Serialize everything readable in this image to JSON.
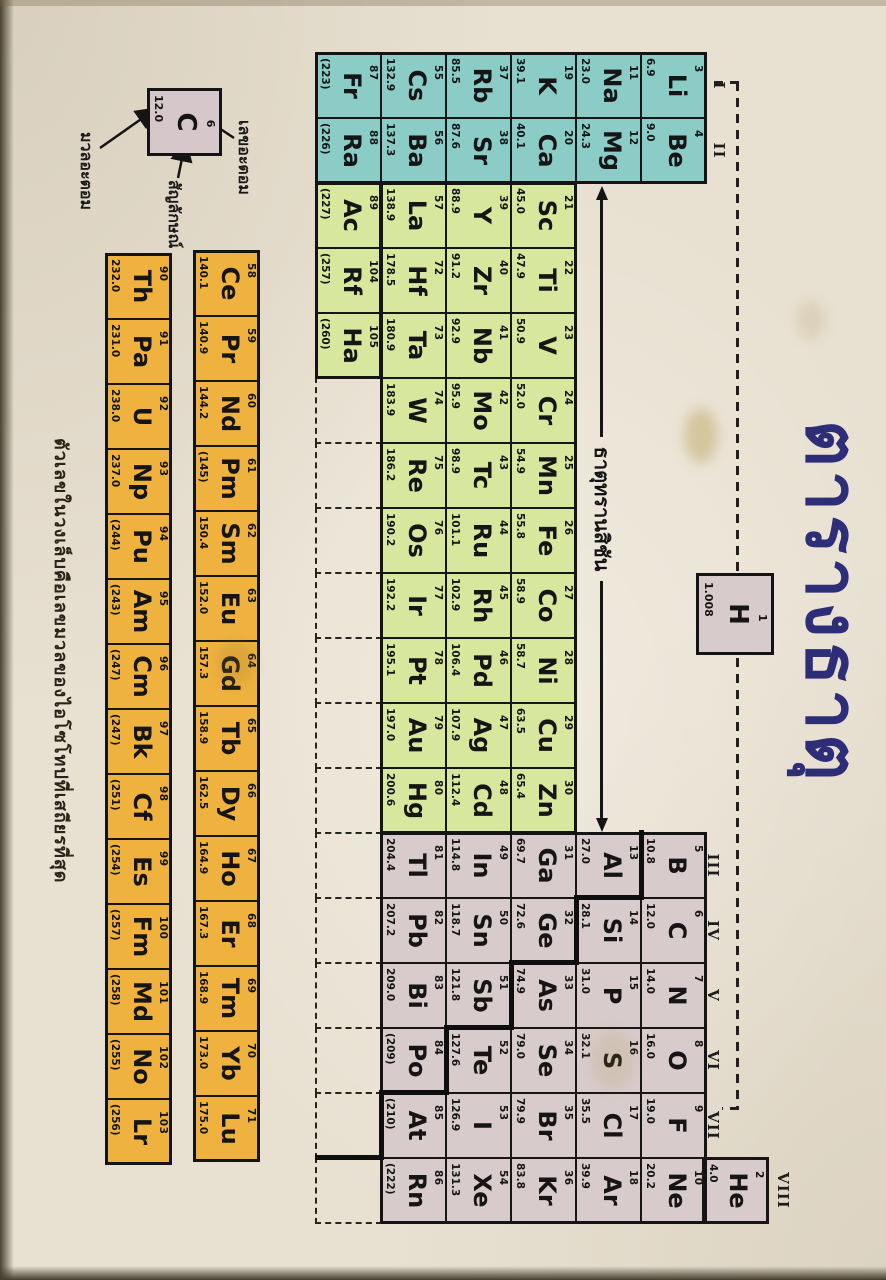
{
  "title": "ตารางธาตุ",
  "transition_label": "ธาตุทรานสิชัน",
  "footnote": "ตัวเลขในวงเล็บคือเลขมวลของไอโซโทปที่เสถียรที่สุด",
  "legend": {
    "number": "6",
    "symbol": "C",
    "mass": "12.0",
    "number_label": "เลขอะตอม",
    "symbol_label": "สัญลักษณ์",
    "mass_label": "มวลอะตอม"
  },
  "group_labels": [
    {
      "label": "I",
      "col": 1
    },
    {
      "label": "II",
      "col": 2
    },
    {
      "label": "III",
      "col": 13
    },
    {
      "label": "IV",
      "col": 14
    },
    {
      "label": "V",
      "col": 15
    },
    {
      "label": "VI",
      "col": 16
    },
    {
      "label": "VII",
      "col": 17
    },
    {
      "label": "VIII",
      "col": 18
    }
  ],
  "hydrogen": {
    "symbol": "H",
    "number": "1",
    "mass": "1.008"
  },
  "helium": {
    "symbol": "He",
    "number": "2",
    "mass": "4.0"
  },
  "elements": [
    {
      "symbol": "Li",
      "number": "3",
      "mass": "6.9",
      "col": 1,
      "row": 2
    },
    {
      "symbol": "Be",
      "number": "4",
      "mass": "9.0",
      "col": 2,
      "row": 2
    },
    {
      "symbol": "B",
      "number": "5",
      "mass": "10.8",
      "col": 13,
      "row": 2
    },
    {
      "symbol": "C",
      "number": "6",
      "mass": "12.0",
      "col": 14,
      "row": 2
    },
    {
      "symbol": "N",
      "number": "7",
      "mass": "14.0",
      "col": 15,
      "row": 2
    },
    {
      "symbol": "O",
      "number": "8",
      "mass": "16.0",
      "col": 16,
      "row": 2
    },
    {
      "symbol": "F",
      "number": "9",
      "mass": "19.0",
      "col": 17,
      "row": 2
    },
    {
      "symbol": "Ne",
      "number": "10",
      "mass": "20.2",
      "col": 18,
      "row": 2
    },
    {
      "symbol": "Na",
      "number": "11",
      "mass": "23.0",
      "col": 1,
      "row": 3
    },
    {
      "symbol": "Mg",
      "number": "12",
      "mass": "24.3",
      "col": 2,
      "row": 3
    },
    {
      "symbol": "Al",
      "number": "13",
      "mass": "27.0",
      "col": 13,
      "row": 3
    },
    {
      "symbol": "Si",
      "number": "14",
      "mass": "28.1",
      "col": 14,
      "row": 3
    },
    {
      "symbol": "P",
      "number": "15",
      "mass": "31.0",
      "col": 15,
      "row": 3
    },
    {
      "symbol": "S",
      "number": "16",
      "mass": "32.1",
      "col": 16,
      "row": 3
    },
    {
      "symbol": "Cl",
      "number": "17",
      "mass": "35.5",
      "col": 17,
      "row": 3
    },
    {
      "symbol": "Ar",
      "number": "18",
      "mass": "39.9",
      "col": 18,
      "row": 3
    },
    {
      "symbol": "K",
      "number": "19",
      "mass": "39.1",
      "col": 1,
      "row": 4
    },
    {
      "symbol": "Ca",
      "number": "20",
      "mass": "40.1",
      "col": 2,
      "row": 4
    },
    {
      "symbol": "Sc",
      "number": "21",
      "mass": "45.0",
      "col": 3,
      "row": 4
    },
    {
      "symbol": "Ti",
      "number": "22",
      "mass": "47.9",
      "col": 4,
      "row": 4
    },
    {
      "symbol": "V",
      "number": "23",
      "mass": "50.9",
      "col": 5,
      "row": 4
    },
    {
      "symbol": "Cr",
      "number": "24",
      "mass": "52.0",
      "col": 6,
      "row": 4
    },
    {
      "symbol": "Mn",
      "number": "25",
      "mass": "54.9",
      "col": 7,
      "row": 4
    },
    {
      "symbol": "Fe",
      "number": "26",
      "mass": "55.8",
      "col": 8,
      "row": 4
    },
    {
      "symbol": "Co",
      "number": "27",
      "mass": "58.9",
      "col": 9,
      "row": 4
    },
    {
      "symbol": "Ni",
      "number": "28",
      "mass": "58.7",
      "col": 10,
      "row": 4
    },
    {
      "symbol": "Cu",
      "number": "29",
      "mass": "63.5",
      "col": 11,
      "row": 4
    },
    {
      "symbol": "Zn",
      "number": "30",
      "mass": "65.4",
      "col": 12,
      "row": 4
    },
    {
      "symbol": "Ga",
      "number": "31",
      "mass": "69.7",
      "col": 13,
      "row": 4
    },
    {
      "symbol": "Ge",
      "number": "32",
      "mass": "72.6",
      "col": 14,
      "row": 4
    },
    {
      "symbol": "As",
      "number": "33",
      "mass": "74.9",
      "col": 15,
      "row": 4
    },
    {
      "symbol": "Se",
      "number": "34",
      "mass": "79.0",
      "col": 16,
      "row": 4
    },
    {
      "symbol": "Br",
      "number": "35",
      "mass": "79.9",
      "col": 17,
      "row": 4
    },
    {
      "symbol": "Kr",
      "number": "36",
      "mass": "83.8",
      "col": 18,
      "row": 4
    },
    {
      "symbol": "Rb",
      "number": "37",
      "mass": "85.5",
      "col": 1,
      "row": 5
    },
    {
      "symbol": "Sr",
      "number": "38",
      "mass": "87.6",
      "col": 2,
      "row": 5
    },
    {
      "symbol": "Y",
      "number": "39",
      "mass": "88.9",
      "col": 3,
      "row": 5
    },
    {
      "symbol": "Zr",
      "number": "40",
      "mass": "91.2",
      "col": 4,
      "row": 5
    },
    {
      "symbol": "Nb",
      "number": "41",
      "mass": "92.9",
      "col": 5,
      "row": 5
    },
    {
      "symbol": "Mo",
      "number": "42",
      "mass": "95.9",
      "col": 6,
      "row": 5
    },
    {
      "symbol": "Tc",
      "number": "43",
      "mass": "98.9",
      "col": 7,
      "row": 5
    },
    {
      "symbol": "Ru",
      "number": "44",
      "mass": "101.1",
      "col": 8,
      "row": 5
    },
    {
      "symbol": "Rh",
      "number": "45",
      "mass": "102.9",
      "col": 9,
      "row": 5
    },
    {
      "symbol": "Pd",
      "number": "46",
      "mass": "106.4",
      "col": 10,
      "row": 5
    },
    {
      "symbol": "Ag",
      "number": "47",
      "mass": "107.9",
      "col": 11,
      "row": 5
    },
    {
      "symbol": "Cd",
      "number": "48",
      "mass": "112.4",
      "col": 12,
      "row": 5
    },
    {
      "symbol": "In",
      "number": "49",
      "mass": "114.8",
      "col": 13,
      "row": 5
    },
    {
      "symbol": "Sn",
      "number": "50",
      "mass": "118.7",
      "col": 14,
      "row": 5
    },
    {
      "symbol": "Sb",
      "number": "51",
      "mass": "121.8",
      "col": 15,
      "row": 5
    },
    {
      "symbol": "Te",
      "number": "52",
      "mass": "127.6",
      "col": 16,
      "row": 5
    },
    {
      "symbol": "I",
      "number": "53",
      "mass": "126.9",
      "col": 17,
      "row": 5
    },
    {
      "symbol": "Xe",
      "number": "54",
      "mass": "131.3",
      "col": 18,
      "row": 5
    },
    {
      "symbol": "Cs",
      "number": "55",
      "mass": "132.9",
      "col": 1,
      "row": 6
    },
    {
      "symbol": "Ba",
      "number": "56",
      "mass": "137.3",
      "col": 2,
      "row": 6
    },
    {
      "symbol": "La",
      "number": "57",
      "mass": "138.9",
      "col": 3,
      "row": 6
    },
    {
      "symbol": "Hf",
      "number": "72",
      "mass": "178.5",
      "col": 4,
      "row": 6
    },
    {
      "symbol": "Ta",
      "number": "73",
      "mass": "180.9",
      "col": 5,
      "row": 6
    },
    {
      "symbol": "W",
      "number": "74",
      "mass": "183.9",
      "col": 6,
      "row": 6
    },
    {
      "symbol": "Re",
      "number": "75",
      "mass": "186.2",
      "col": 7,
      "row": 6
    },
    {
      "symbol": "Os",
      "number": "76",
      "mass": "190.2",
      "col": 8,
      "row": 6
    },
    {
      "symbol": "Ir",
      "number": "77",
      "mass": "192.2",
      "col": 9,
      "row": 6
    },
    {
      "symbol": "Pt",
      "number": "78",
      "mass": "195.1",
      "col": 10,
      "row": 6
    },
    {
      "symbol": "Au",
      "number": "79",
      "mass": "197.0",
      "col": 11,
      "row": 6
    },
    {
      "symbol": "Hg",
      "number": "80",
      "mass": "200.6",
      "col": 12,
      "row": 6
    },
    {
      "symbol": "Tl",
      "number": "81",
      "mass": "204.4",
      "col": 13,
      "row": 6
    },
    {
      "symbol": "Pb",
      "number": "82",
      "mass": "207.2",
      "col": 14,
      "row": 6
    },
    {
      "symbol": "Bi",
      "number": "83",
      "mass": "209.0",
      "col": 15,
      "row": 6
    },
    {
      "symbol": "Po",
      "number": "84",
      "mass": "(209)",
      "col": 16,
      "row": 6
    },
    {
      "symbol": "At",
      "number": "85",
      "mass": "(210)",
      "col": 17,
      "row": 6
    },
    {
      "symbol": "Rn",
      "number": "86",
      "mass": "(222)",
      "col": 18,
      "row": 6
    },
    {
      "symbol": "Fr",
      "number": "87",
      "mass": "(223)",
      "col": 1,
      "row": 7
    },
    {
      "symbol": "Ra",
      "number": "88",
      "mass": "(226)",
      "col": 2,
      "row": 7
    },
    {
      "symbol": "Ac",
      "number": "89",
      "mass": "(227)",
      "col": 3,
      "row": 7
    },
    {
      "symbol": "Rf",
      "number": "104",
      "mass": "(257)",
      "col": 4,
      "row": 7
    },
    {
      "symbol": "Ha",
      "number": "105",
      "mass": "(260)",
      "col": 5,
      "row": 7
    }
  ],
  "lanthanides": [
    {
      "symbol": "Ce",
      "number": "58",
      "mass": "140.1"
    },
    {
      "symbol": "Pr",
      "number": "59",
      "mass": "140.9"
    },
    {
      "symbol": "Nd",
      "number": "60",
      "mass": "144.2"
    },
    {
      "symbol": "Pm",
      "number": "61",
      "mass": "(145)"
    },
    {
      "symbol": "Sm",
      "number": "62",
      "mass": "150.4"
    },
    {
      "symbol": "Eu",
      "number": "63",
      "mass": "152.0"
    },
    {
      "symbol": "Gd",
      "number": "64",
      "mass": "157.3"
    },
    {
      "symbol": "Tb",
      "number": "65",
      "mass": "158.9"
    },
    {
      "symbol": "Dy",
      "number": "66",
      "mass": "162.5"
    },
    {
      "symbol": "Ho",
      "number": "67",
      "mass": "164.9"
    },
    {
      "symbol": "Er",
      "number": "68",
      "mass": "167.3"
    },
    {
      "symbol": "Tm",
      "number": "69",
      "mass": "168.9"
    },
    {
      "symbol": "Yb",
      "number": "70",
      "mass": "173.0"
    },
    {
      "symbol": "Lu",
      "number": "71",
      "mass": "175.0"
    }
  ],
  "actinides": [
    {
      "symbol": "Th",
      "number": "90",
      "mass": "232.0"
    },
    {
      "symbol": "Pa",
      "number": "91",
      "mass": "231.0"
    },
    {
      "symbol": "U",
      "number": "92",
      "mass": "238.0"
    },
    {
      "symbol": "Np",
      "number": "93",
      "mass": "237.0"
    },
    {
      "symbol": "Pu",
      "number": "94",
      "mass": "(244)"
    },
    {
      "symbol": "Am",
      "number": "95",
      "mass": "(243)"
    },
    {
      "symbol": "Cm",
      "number": "96",
      "mass": "(247)"
    },
    {
      "symbol": "Bk",
      "number": "97",
      "mass": "(247)"
    },
    {
      "symbol": "Cf",
      "number": "98",
      "mass": "(251)"
    },
    {
      "symbol": "Es",
      "number": "99",
      "mass": "(254)"
    },
    {
      "symbol": "Fm",
      "number": "100",
      "mass": "(257)"
    },
    {
      "symbol": "Md",
      "number": "101",
      "mass": "(258)"
    },
    {
      "symbol": "No",
      "number": "102",
      "mass": "(255)"
    },
    {
      "symbol": "Lr",
      "number": "103",
      "mass": "(256)"
    }
  ],
  "colors": {
    "alkali_teal": "#8cccc6",
    "transition_green": "#d8e79e",
    "pblock_gray": "#d8cbcb",
    "f_block_orange": "#f0b23e",
    "paper": "#e8e0d1",
    "title_navy": "#2e2e78",
    "ink": "#161616"
  }
}
